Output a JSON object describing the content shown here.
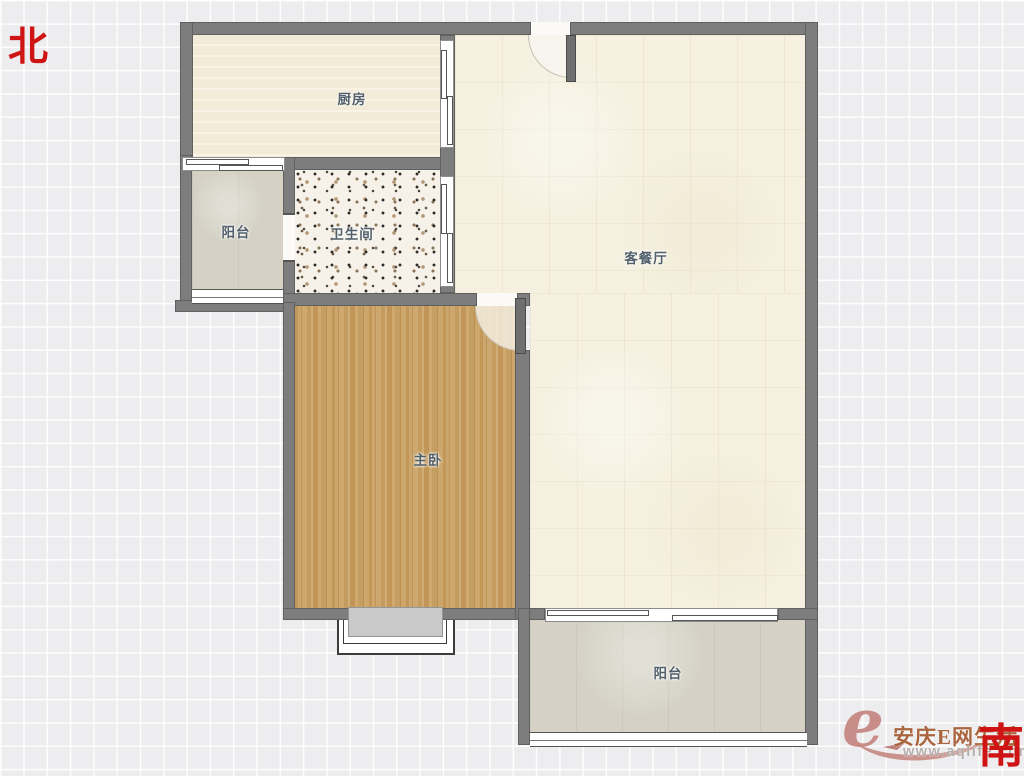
{
  "compass": {
    "north_label": "北",
    "south_label": "南"
  },
  "rooms": {
    "kitchen": {
      "label": "厨房"
    },
    "north_balcony": {
      "label": "阳台"
    },
    "bathroom": {
      "label": "卫生间"
    },
    "living_dining": {
      "label": "客餐厅"
    },
    "master_bedroom": {
      "label": "主卧"
    },
    "south_balcony": {
      "label": "阳台"
    }
  },
  "watermark": {
    "logo_letter": "e",
    "site_name": "安庆E网生活",
    "site_url": "www.aqlife.com"
  },
  "colors": {
    "compass_red": "#cf1414",
    "wall_gray": "#7d7d7d",
    "wood_floor": "#c7a066",
    "living_tile": "#f5f0df",
    "kitchen_tile": "#f2ebd8",
    "balcony_floor": "#d5d2c5",
    "bathroom_floor": "#f6f2e9",
    "watermark_rose": "#c5837d",
    "watermark_brown": "#a55a2f"
  }
}
